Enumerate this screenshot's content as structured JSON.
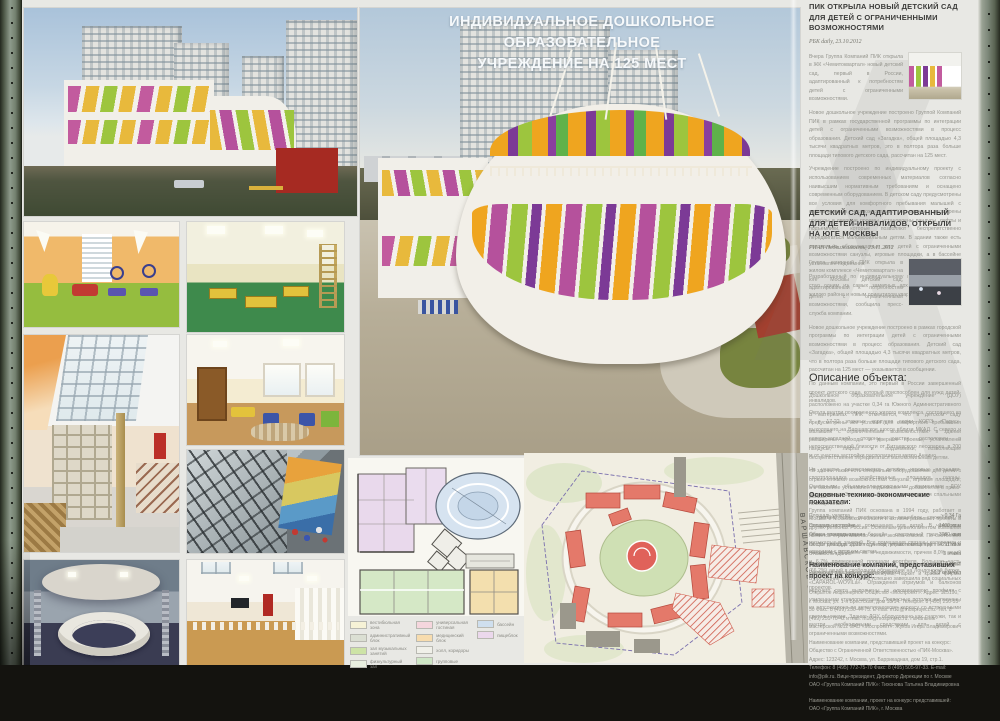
{
  "board": {
    "title_line1": "ИНДИВИДУАЛЬНОЕ ДОШКОЛЬНОЕ ОБРАЗОВАТЕЛЬНОЕ",
    "title_line2": "УЧРЕЖДЕНИЕ НА 125 МЕСТ"
  },
  "articles": [
    {
      "heading": "ПИК ОТКРЫЛА НОВЫЙ ДЕТСКИЙ САД ДЛЯ ДЕТЕЙ С ОГРАНИЧЕННЫМИ ВОЗМОЖНОСТЯМИ",
      "source": "РБК daily, 23.10.2012",
      "paragraphs": [
        "Вчера Группа Компаний ПИК открыла в ЖК «Чемитоквартал» новый детский сад, первый в России, адаптированный к потребностям детей с ограниченными возможностями.",
        "Новое дошкольное учреждение построено Группой Компаний ПИК в рамках государственной программы по интеграции детей с ограниченными возможностями в процесс образования. Детский сад «Загадка», общей площадью 4,3 тысячи квадратных метров, это в полтора раза больше площади типового детского сада, рассчитан на 125 мест.",
        "Учреждение построено по индивидуальному проекту с использованием современных материалов согласно наивысшим нормативным требованиям и оснащено современным оборудованием. В детском саду предусмотрены все условия для комфортного пребывания малышей с ограниченными возможностями: в здании расширены проходы и дверные проемы, установлены пандусы, лифты и подъемники, которые позволяют беспрепятственно передвигаться маломобильным детям. В здании также есть специально оборудованные для детей с ограниченными возможностями санузлы, игровые площадки, а в бассейне установлен подъемник.",
        "Разработанный по индивидуальному проекту детский сад стал одним из самых заметных архитектурных решений жилого района и новым ориентиром квартала."
      ]
    },
    {
      "heading": "ДЕТСКИЙ САД, АДАПТИРОВАННЫЙ ДЛЯ ДЕТЕЙ-ИНВАЛИДОВ, ОТКРЫЛИ НА ЮГЕ МОСКВЫ",
      "source": "РИАН Недвижимость, 23.11.2012",
      "paragraphs": [
        "Группа компаний ПИК открыла в жилом комплексе «Чемитоквартал» на юге Москвы детский сад, адаптированный к потребностям детей с ограниченными возможностями, сообщила пресс-служба компании.",
        "Новое дошкольное учреждение построено в рамках городской программы по интеграции детей с ограниченными возможностями в процесс образования. Детский сад «Загадка», общей площадью 4,3 тысячи квадратных метров, что в полтора раза больше площади типового детского сада, рассчитан на 125 мест — указывается в сообщении.",
        "По данным компании, это первый в России завершенный проект детского сада, который приспособлен для нужд детей-инвалидов.",
        "В материалах ПИК отмечается, что в детском саду предусмотрены все условия для комфортного пребывания малышей с ограниченными возможностями: в здании расширены проходы и дверные проемы, установлены пандусы, лифты и подъемники, позволяющие беспрепятственно передвигаться маломобильным детям.",
        "«В здании также есть специально оборудованные для детей с ограниченными возможностями санузлы, игровые площадки, а в бассейне установлен подъемник» — добавляется в пресс-релизе.",
        "Группа компаний ПИК основана в 1994 году, работает в Москве и Московской области и активно развивает проекты в других регионах России. Основным девелопментом компании является строительство жилья эконом-класса. По состоянию на 31 декабря 2011 года под управлением группы «ПИК» находилось 10,8 млн кв. м недвижимости, причем 8,0% акций и 6,7% приведенной площади портфеля. Большая часть (66,2%) акций в свободном обращении на Лондонской бирже. В последние годы группа успешно завершила ряд социальных проектов."
      ]
    }
  ],
  "description": {
    "heading": "Описание объекта:",
    "paragraphs": [
      "Дошкольное образовательное учреждение (ДОУ) расположено на участке 0,34 га Южного Административного Округа внутри построенного жилого комплекса, состоящего из 3 и 17-22 этажных корпусов серии КОПЭ «Парус», выходящего на Варшавское шоссе вблизи МКАД. С северо и северо-западной стороны участок расположен в непосредственной близости от Битцевского лесопарка, в 200 м от участка застройки располагается метро Аннино.",
      "На участке располагаются детские игровые площадки, спортплощадка, хозяйственные площадки, газоны. Основными объемно-планировочными элементами ДОУ являются два 3-х этажных блока с групповыми и спальными помещениями.",
      "В третьем блоке располагаются пищеблок, служебные и специализированные помещения для детей. В четвертом блоке расположены бассейн, спортивный зал и зал музыкальных занятий. Все помещения связаны галереями и атриумом с верхним светом.",
      "Во внутренней отделке широко применены итальянские керамические плитки, линолеумы, паркет и краски фирмы «CAPAROL-WOVILа». Ограждения атриумов и балконов верхнего света выполнены из алюминиевого профиля с усиленными стеклопакетами. Подвесные потолки выполнены из гипсокартона по металлическому каркасу со встроенными светильниками. Здание ДОУ оборудовано как снаружи, так и внутри необходимыми средствами для детей с ограниченными возможностями."
    ]
  },
  "indicators": {
    "heading": "Основные технико-экономические показатели:",
    "rows": [
      {
        "label": "Площадь участка",
        "value": "~ 0,34 Га"
      },
      {
        "label": "Площадь застройки",
        "value": "1400 кв.м"
      },
      {
        "label": "Общая площадь здания",
        "value": "3980 кв.м"
      },
      {
        "label": "Общая площадь здания с учетом летних помещений",
        "value": "4211 кв.м"
      },
      {
        "label": "Этажность здания",
        "value": "3 этажа"
      },
      {
        "label": "Вместимость",
        "value": "125 мест"
      },
      {
        "label": "Расчетная площадь на одного ребенка",
        "value": "16,3 кв.м/чел"
      }
    ]
  },
  "companies": {
    "heading": "Наименование компаний, представивших проект на конкурс:",
    "blocks": [
      "Открытое Акционерное Общество «Моспроект». Адрес: 125190, г. Москва, ул. 1-я Брестская, дом 13/14. Телефон: 8 (495) 250-55-30 Факс: 8 (499) 250-44-75. E-mail: m12@mosproject.ru. Тел. 8 (499) 251-70-42 и mail: m12@mosproject.ru. Начальник мастерской №12 ОАО «Моспроект»: Жуков Игорь Владимирович",
      "Наименование компании, представившей проект на конкурс: Общество с Ограниченной Ответственностью «ПИК-Москва». Адрес: 123242, г. Москва, ул. Баррикадная, дом 19, стр.1. Телефон: 8 (495) 772-75-70 Факс: 8 (495) 505-97-33. E-mail: info@pik.ru. Вице-президент, Директор Дирекции по г. Москве ОАО «Группа Компаний ПИК»: Тихонова Татьяна Владимировна",
      "Наименование компании, проект на конкурс представившей: ОАО «Группа Компаний ПИК», г. Москва"
    ]
  },
  "site_plan": {
    "road_label": "ВАРШАВСКОЕ ШОССЕ"
  },
  "legend": {
    "items": [
      {
        "color": "#f6f2d6",
        "label": "вестибюльная зона"
      },
      {
        "color": "#dbdfd3",
        "label": "административный блок"
      },
      {
        "color": "#cde3a6",
        "label": "зал музыкальных занятий"
      },
      {
        "color": "#e9efdf",
        "label": "физкультурный зал"
      },
      {
        "color": "#f5d6dd",
        "label": "универсальная гостиная"
      },
      {
        "color": "#f7dcae",
        "label": "медицинский блок"
      },
      {
        "color": "#f0f0e9",
        "label": "холл, коридоры"
      },
      {
        "color": "#cfe7c6",
        "label": "групповые"
      },
      {
        "color": "#cfdfee",
        "label": "бассейн"
      },
      {
        "color": "#ebd8ec",
        "label": "пищеблок"
      }
    ]
  },
  "palette": {
    "facade_orange": "#efa51f",
    "facade_magenta": "#b5519c",
    "facade_green": "#9dc53e",
    "facade_purple": "#7c3a96"
  }
}
